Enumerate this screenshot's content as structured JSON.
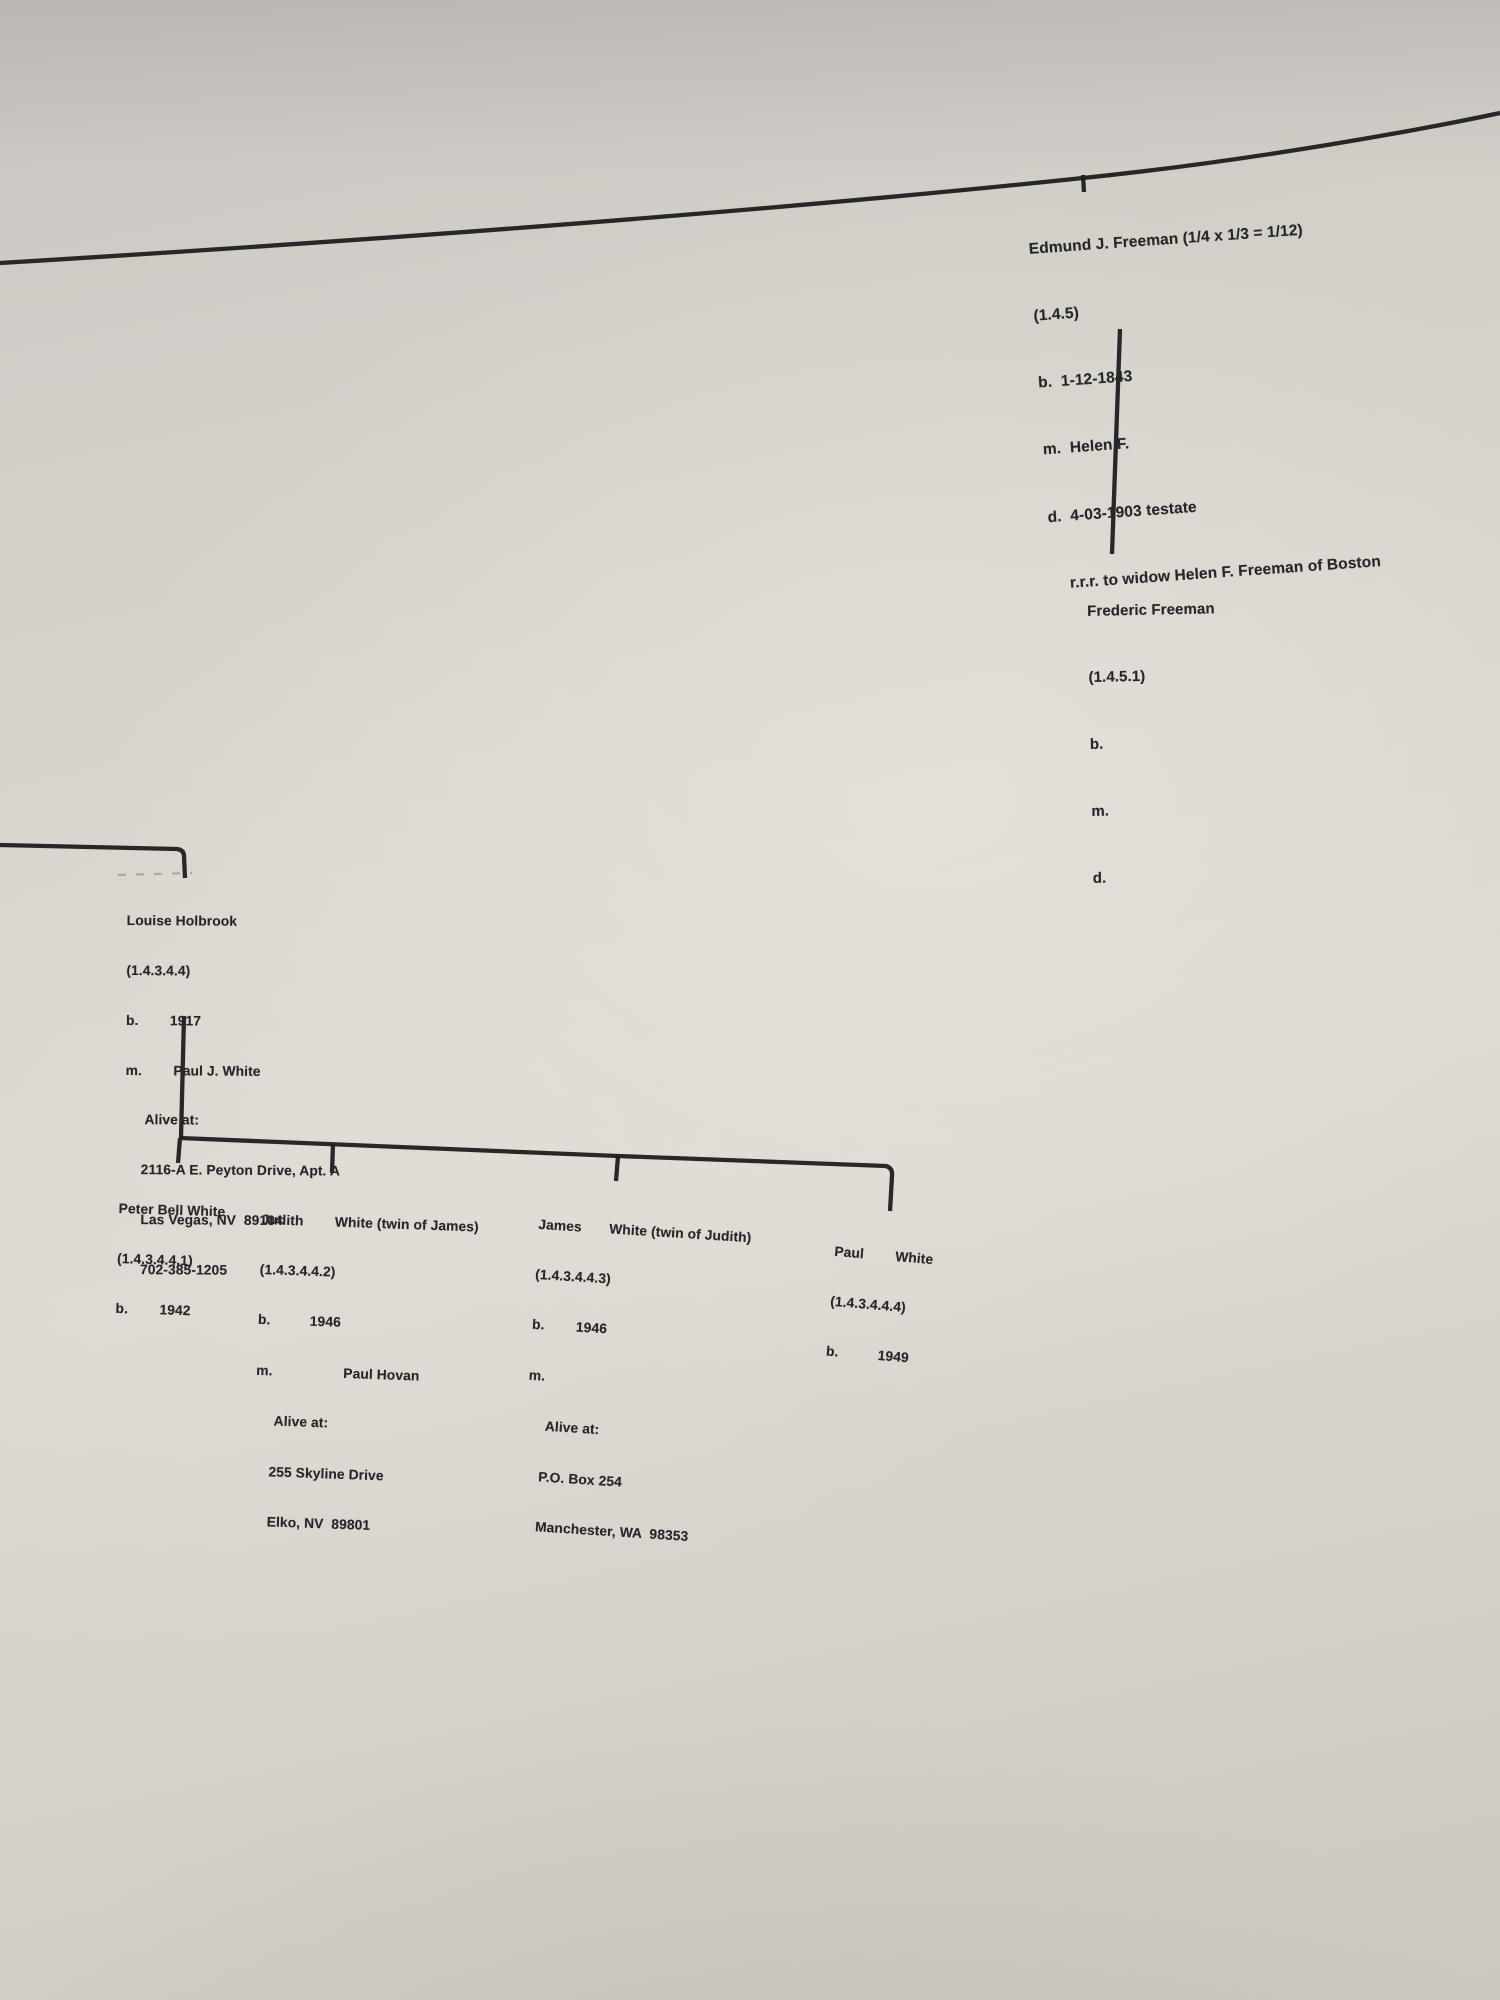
{
  "colors": {
    "paper": "#d6d2cb",
    "ink": "#1d1d20",
    "text": "#26262a"
  },
  "nodes": {
    "edmund": {
      "lines": [
        "Edmund J. Freeman (1/4 x 1/3 = 1/12)",
        "(1.4.5)",
        "b.  1-12-1843",
        "m.  Helen F.",
        "d.  4-03-1903 testate",
        "    r.r.r. to widow Helen F. Freeman of Boston"
      ]
    },
    "frederic": {
      "lines": [
        "Frederic Freeman",
        "(1.4.5.1)",
        "b.",
        "m.",
        "d."
      ]
    },
    "louise": {
      "lines": [
        "Louise Holbrook",
        "(1.4.3.4.4)",
        "b.        1917",
        "m.        Paul J. White",
        "     Alive at:",
        "    2116-A E. Peyton Drive, Apt. A",
        "    Las Vegas, NV  89104",
        "    702-385-1205"
      ]
    },
    "peter": {
      "lines": [
        "Peter Bell White",
        "(1.4.3.4.4.1)",
        "b.        1942"
      ]
    },
    "judith": {
      "lines": [
        "Judith        White (twin of James)",
        "(1.4.3.4.4.2)",
        "b.          1946",
        "m.                  Paul Hovan",
        "     Alive at:",
        "    255 Skyline Drive",
        "    Elko, NV  89801"
      ]
    },
    "james": {
      "lines": [
        "James       White (twin of Judith)",
        "(1.4.3.4.4.3)",
        "b.        1946",
        "m.",
        "     Alive at:",
        "    P.O. Box 254",
        "    Manchester, WA  98353"
      ]
    },
    "paul": {
      "lines": [
        "Paul        White",
        "(1.4.3.4.4.4)",
        "b.          1949"
      ]
    }
  }
}
